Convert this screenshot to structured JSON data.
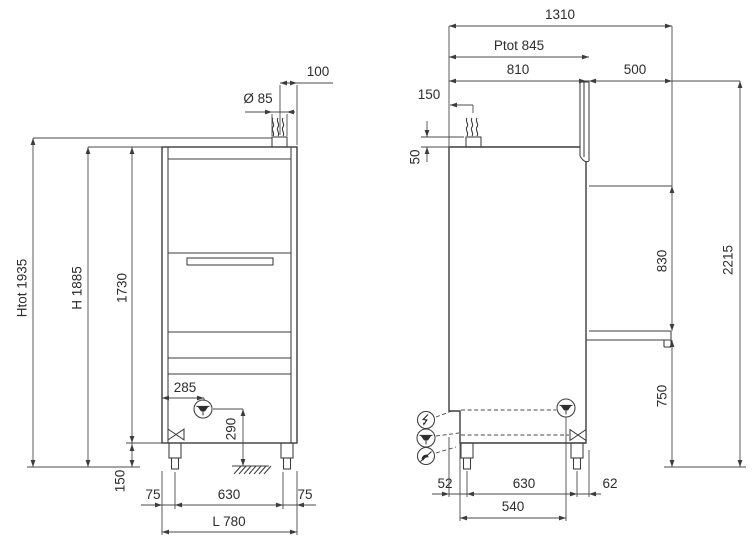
{
  "drawing_title": "dishwasher-dimension-drawing",
  "colors": {
    "line": "#3c3c3c",
    "text": "#2d2d2d",
    "background": "#ffffff"
  },
  "front": {
    "dims": {
      "vent_offset_100": "100",
      "vent_diameter": "Ø 85",
      "total_height": "Htot 1935",
      "work_height": "H 1885",
      "body_height": "1730",
      "drain_offset": "285",
      "drain_height": "290",
      "leg_height": "150",
      "leg_inset_left": "75",
      "leg_span": "630",
      "leg_inset_right": "75",
      "total_width": "L 780"
    }
  },
  "side": {
    "dims": {
      "total_depth": "1310",
      "depth_with_door": "Ptot 845",
      "body_depth": "810",
      "shelf_depth": "500",
      "vent_offset": "150",
      "vent_height": "50",
      "hood_clearance": "830",
      "open_hood_height": "2215",
      "shelf_height": "750",
      "leg_inset_back": "52",
      "leg_span": "630",
      "leg_inset_front": "62",
      "drain_offset": "540"
    }
  },
  "icons": {
    "steam": "steam-vent-icon",
    "drain": "drain-outlet-icon",
    "valve": "shutoff-valve-icon",
    "electrical": "electrical-connection-icon",
    "water": "water-inlet-icon",
    "ground": "ground-hatch-icon"
  }
}
